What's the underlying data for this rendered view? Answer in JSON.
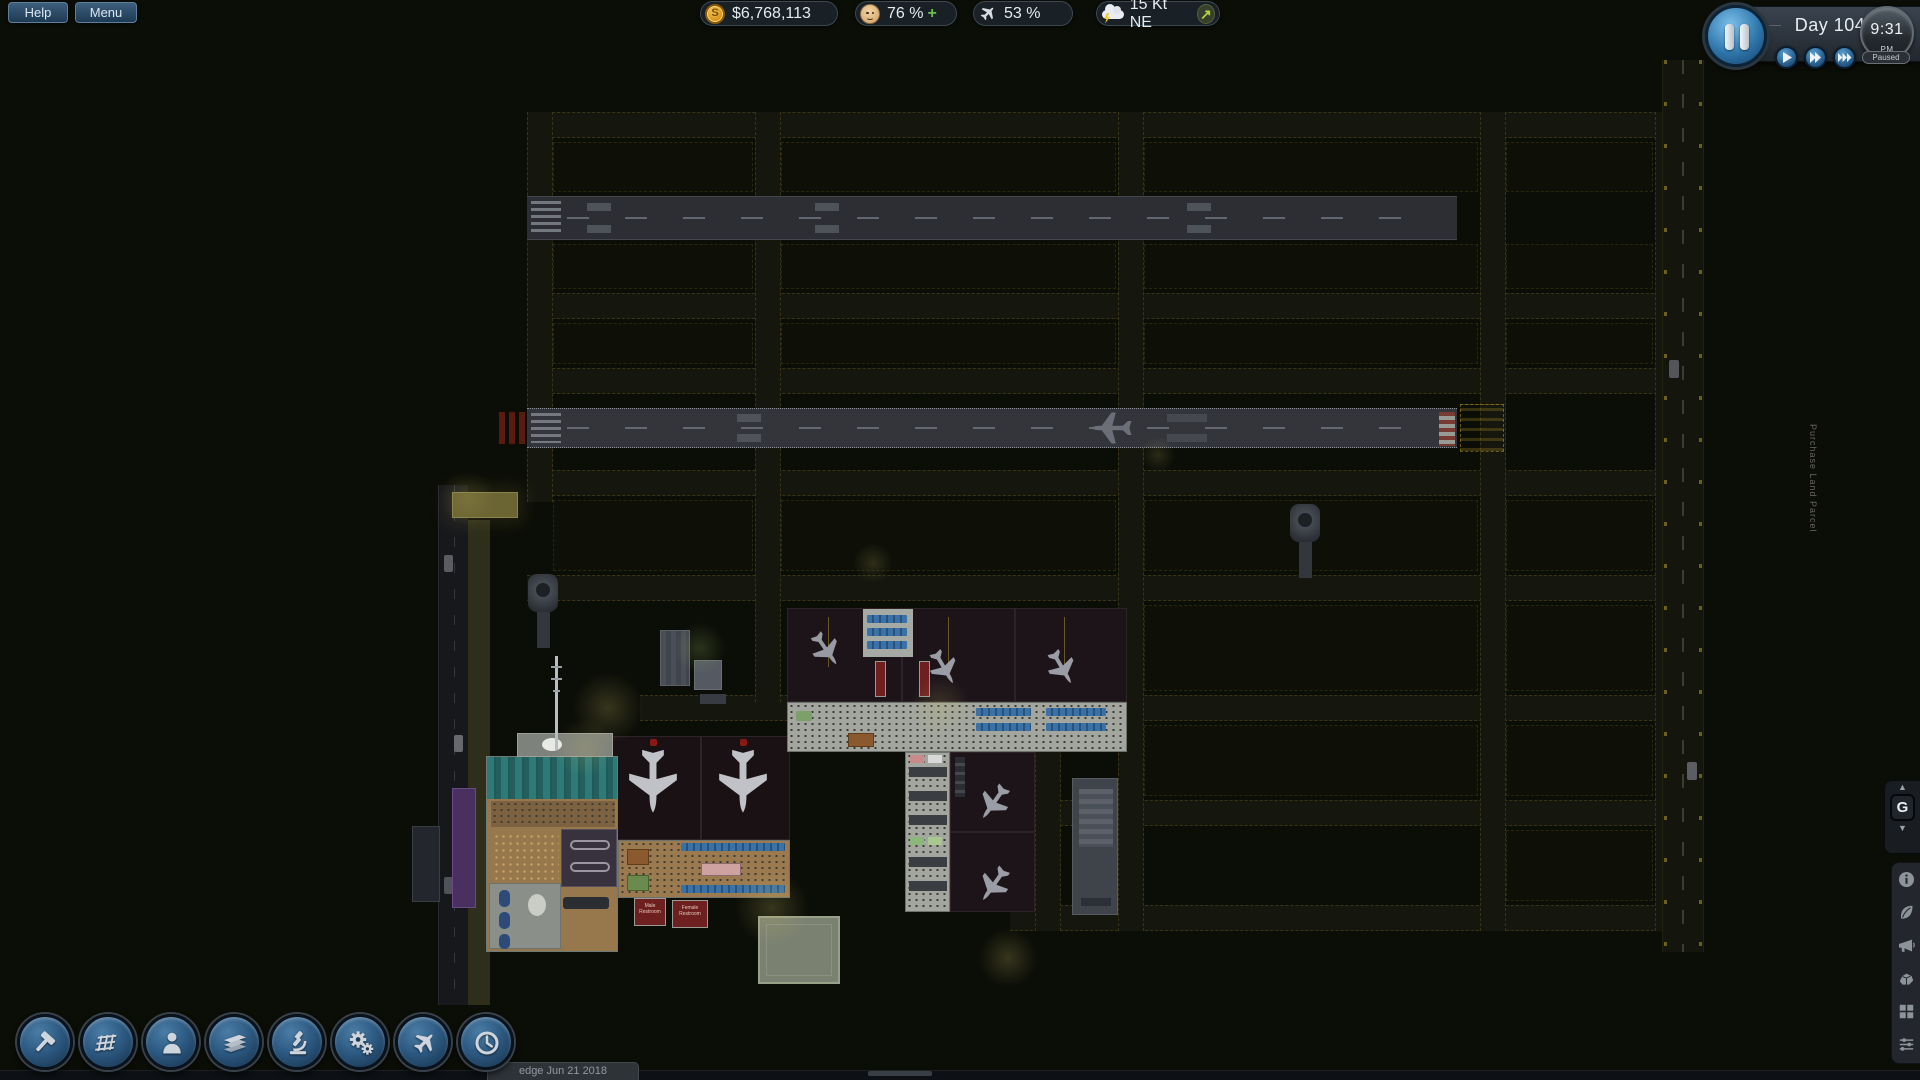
{
  "topbar": {
    "help_label": "Help",
    "menu_label": "Menu"
  },
  "stats": {
    "money": {
      "icon": "coin-icon",
      "value": "$6,768,113"
    },
    "passengers": {
      "icon": "passenger-face-icon",
      "value": "76 %",
      "trend": "+"
    },
    "flights": {
      "icon": "airplane-icon",
      "value": "53 %"
    },
    "weather": {
      "icon": "storm-cloud-icon",
      "value": "15 Kt NE",
      "direction_icon": "wind-ne-arrow-icon",
      "direction_glyph": "↗"
    }
  },
  "time_panel": {
    "day": "Day 104",
    "clock": "9:31",
    "meridiem": "PM",
    "status": "Paused",
    "buttons": [
      {
        "name": "pause",
        "icon": "pause-icon"
      },
      {
        "name": "play",
        "icon": "play-icon"
      },
      {
        "name": "fast-forward",
        "icon": "fast-forward-icon"
      },
      {
        "name": "fastest-forward",
        "icon": "fastest-forward-icon"
      }
    ]
  },
  "toolbar": [
    {
      "name": "construction",
      "icon": "hammer-icon"
    },
    {
      "name": "floors",
      "icon": "floor-tiles-icon"
    },
    {
      "name": "staff",
      "icon": "person-icon"
    },
    {
      "name": "materials",
      "icon": "planks-icon"
    },
    {
      "name": "research",
      "icon": "microscope-icon"
    },
    {
      "name": "systems",
      "icon": "gears-icon"
    },
    {
      "name": "aircraft",
      "icon": "airplane-icon"
    },
    {
      "name": "schedule",
      "icon": "clock-icon"
    }
  ],
  "floor_selector": {
    "label": "G",
    "up_glyph": "▲",
    "down_glyph": "▼"
  },
  "side_tools": [
    {
      "name": "info",
      "icon": "info-icon"
    },
    {
      "name": "environment",
      "icon": "leaf-icon"
    },
    {
      "name": "marketing",
      "icon": "megaphone-icon"
    },
    {
      "name": "terrain",
      "icon": "rock-icon"
    },
    {
      "name": "overlays",
      "icon": "grid-squares-icon"
    },
    {
      "name": "filters",
      "icon": "sliders-icon"
    }
  ],
  "map": {
    "purchase_land_label": "Purchase Land Parcel",
    "signs": {
      "male_restroom": "Male Restroom",
      "female_restroom": "Female Restroom"
    }
  },
  "statusbar": {
    "version": "edge Jun 21 2018"
  },
  "colors": {
    "accent_blue": "#4a9fd4",
    "money_gold": "#e8a21e",
    "trend_green": "#6fbf4f",
    "wind_arrow_green": "#aad437",
    "night_bg": "#0b0d07"
  }
}
